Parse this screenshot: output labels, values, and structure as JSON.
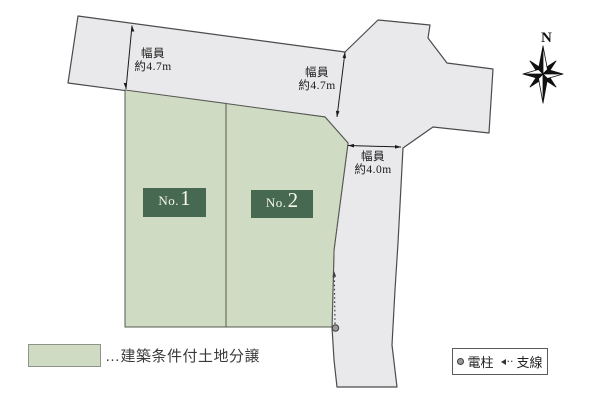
{
  "compass": {
    "north_label": "N"
  },
  "measurements": {
    "top_road": {
      "title": "幅員",
      "value": "約4.7m"
    },
    "intersection": {
      "title": "幅員",
      "value": "約4.7m"
    },
    "side_road": {
      "title": "幅員",
      "value": "約4.0m"
    }
  },
  "plots": {
    "no1": {
      "prefix": "No.",
      "number": "1"
    },
    "no2": {
      "prefix": "No.",
      "number": "2"
    }
  },
  "legend": {
    "land_note": "…建築条件付土地分譲",
    "pole_label": "電柱",
    "guy_label": "支線"
  },
  "colors": {
    "plot_fill": "#cfdcc3",
    "plot_label_bg": "#486951",
    "road_fill": "#e9e9eb",
    "outline": "#4b4b4e"
  }
}
